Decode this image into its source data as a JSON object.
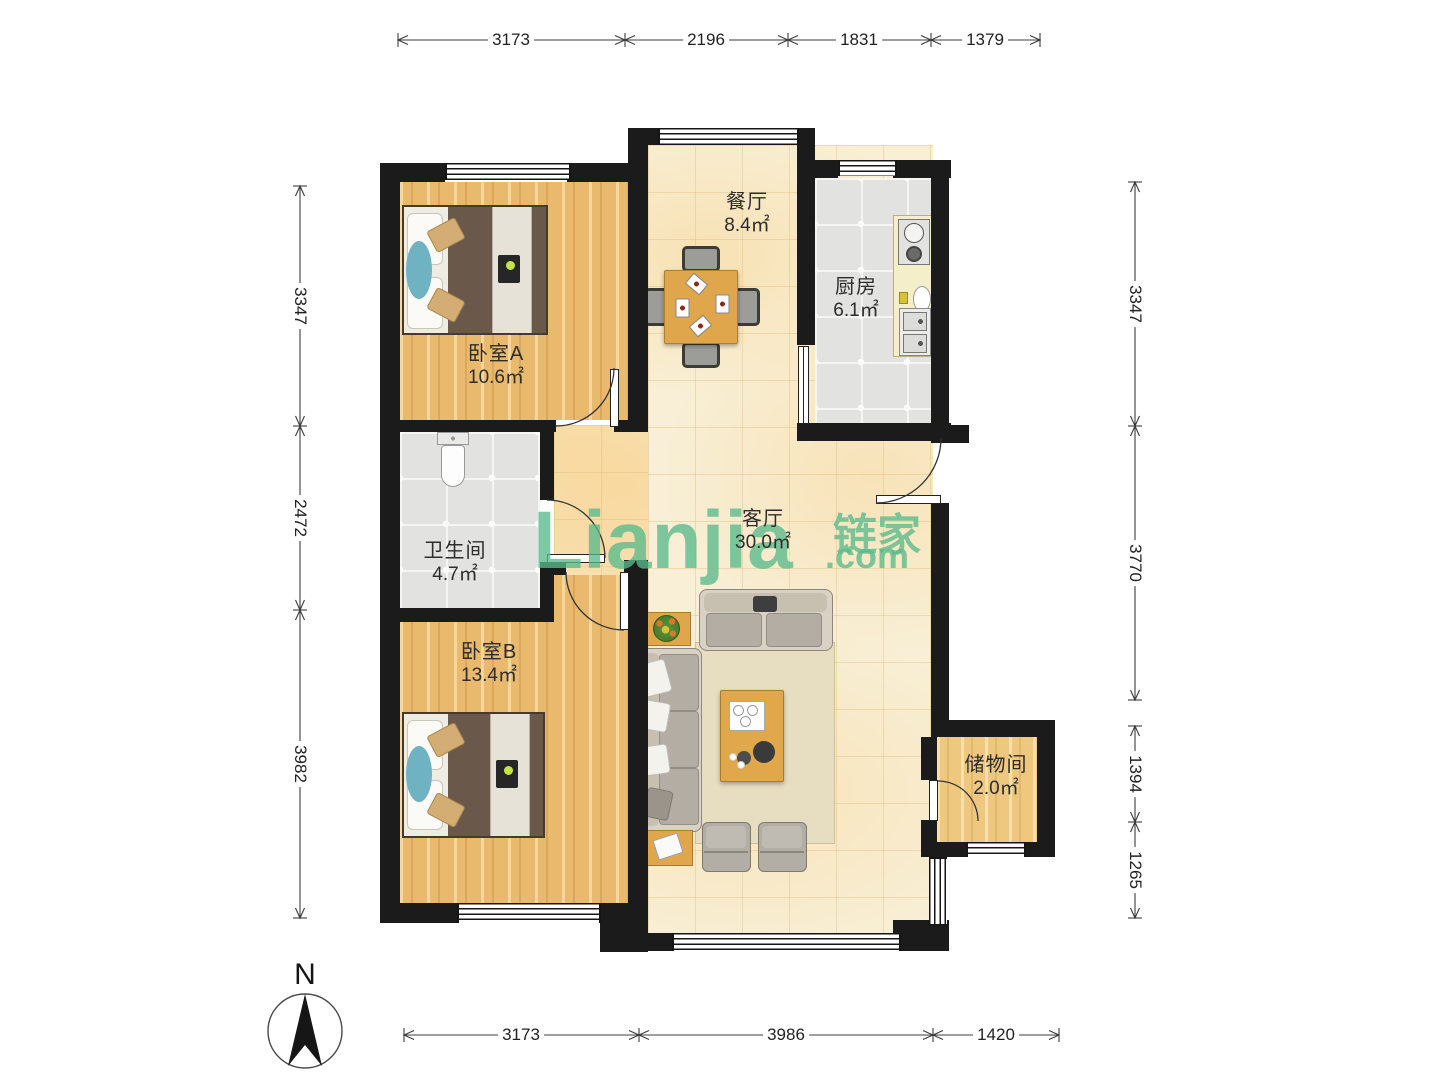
{
  "title": "户型图 (floor plan)",
  "watermark": {
    "brand": "Lianjia",
    "brand_cn": "链家",
    "domain": ".com",
    "color": "#54b98a"
  },
  "compass": {
    "label": "N"
  },
  "rooms": {
    "dining": {
      "name": "餐厅",
      "area": "8.4㎡"
    },
    "kitchen": {
      "name": "厨房",
      "area": "6.1㎡"
    },
    "bedroom_a": {
      "name": "卧室A",
      "area": "10.6㎡"
    },
    "bathroom": {
      "name": "卫生间",
      "area": "4.7㎡"
    },
    "living": {
      "name": "客厅",
      "area": "30.0㎡"
    },
    "bedroom_b": {
      "name": "卧室B",
      "area": "13.4㎡"
    },
    "storage": {
      "name": "储物间",
      "area": "2.0㎡"
    }
  },
  "dimensions": {
    "top": [
      "3173",
      "2196",
      "1831",
      "1379"
    ],
    "bottom": [
      "3173",
      "3986",
      "1420"
    ],
    "left": [
      "3347",
      "2472",
      "3982"
    ],
    "right": [
      "3347",
      "3770",
      "1394",
      "1265"
    ]
  },
  "colors": {
    "wall": "#1b1b1b",
    "wood_floor": "#e9b96e",
    "tile_warm": "#f8efd6",
    "tile_gray": "#e2e2e0",
    "watermark_green": "#54b98a"
  }
}
